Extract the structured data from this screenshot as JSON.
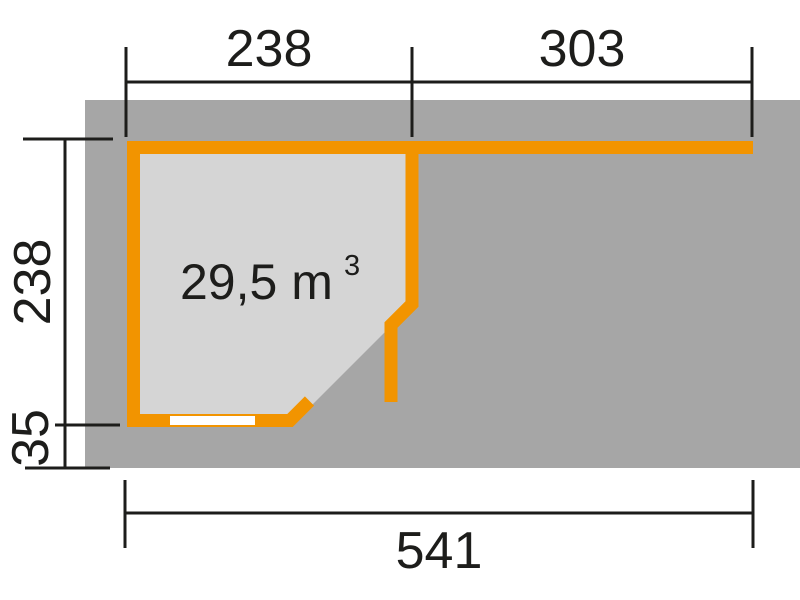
{
  "floor_plan": {
    "volume": {
      "value": "29,5 m",
      "exponent": "3"
    },
    "dimensions": {
      "top_left": "238",
      "top_right": "303",
      "side": "238",
      "side_bottom": "35",
      "bottom": "541"
    },
    "colors": {
      "background": "#ffffff",
      "platform": "#a6a6a6",
      "interior": "#d5d5d5",
      "wall": "#f29400",
      "dimension_line": "#1d1d1b",
      "window": "#ffffff"
    }
  }
}
